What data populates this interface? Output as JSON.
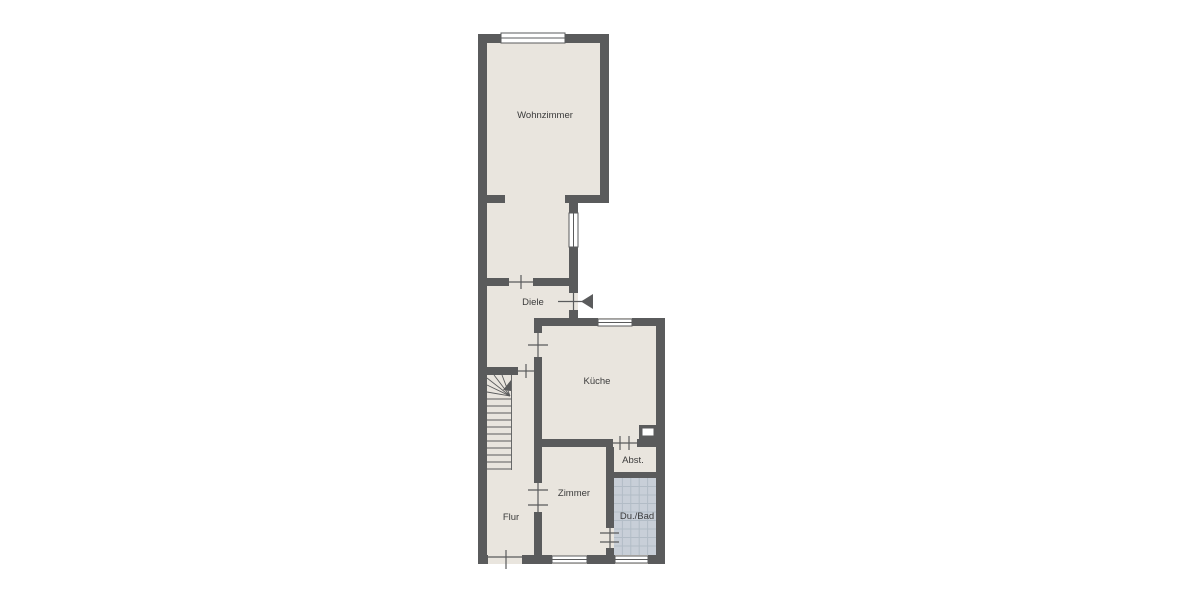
{
  "plan": {
    "type": "floor-plan",
    "rooms": [
      {
        "name": "wohnzimmer",
        "label": "Wohnzimmer"
      },
      {
        "name": "diele",
        "label": "Diele"
      },
      {
        "name": "kueche",
        "label": "Küche"
      },
      {
        "name": "abstellraum",
        "label": "Abst."
      },
      {
        "name": "zimmer",
        "label": "Zimmer"
      },
      {
        "name": "flur",
        "label": "Flur"
      },
      {
        "name": "dusche-bad",
        "label": "Du./Bad"
      }
    ],
    "colors": {
      "background": "#ffffff",
      "wall": "#5a5b5c",
      "floor": "#e9e5de",
      "tile": "#c8cfd8",
      "tile_grid": "#b2bcc6",
      "window": "#ffffff",
      "label": "#3b3b3b"
    }
  }
}
